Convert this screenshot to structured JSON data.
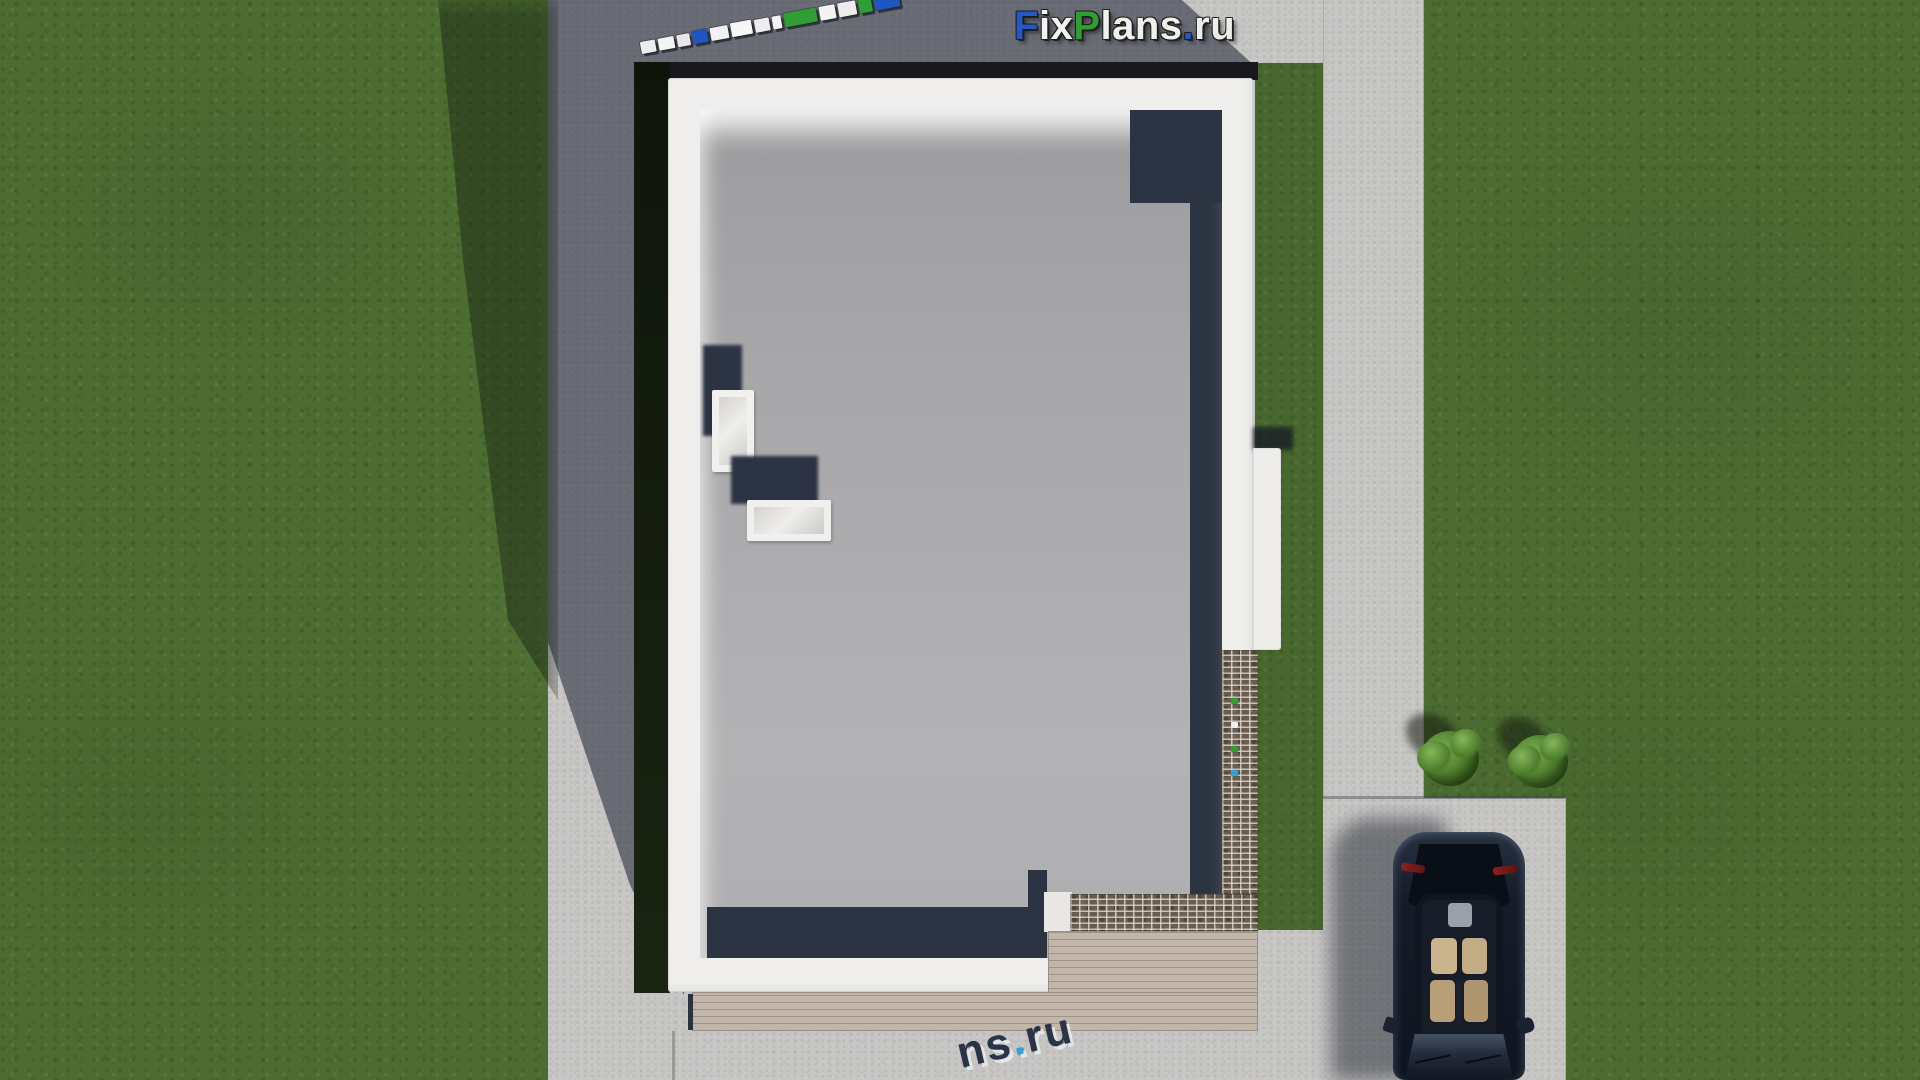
{
  "scene": {
    "description": "Top-down 3D architectural render of a flat-roof house site plan with courtyard, walkway, parking pad, car and shrubs",
    "logo": {
      "full_text": "FixPlans.ru",
      "segments": [
        {
          "text": "F",
          "color": "#2457c8"
        },
        {
          "text": "ix",
          "color": "#f2f2ef"
        },
        {
          "text": "P",
          "color": "#2f9e33"
        },
        {
          "text": "lans",
          "color": "#f0f0ed"
        },
        {
          "text": ".",
          "color": "#2457c8"
        },
        {
          "text": "ru",
          "color": "#edede9"
        }
      ]
    },
    "watermark_bottom": {
      "full_text": "ns.ru",
      "segments": [
        {
          "text": "ns",
          "color": "#2b3347"
        },
        {
          "text": ".",
          "color": "#2aa3de"
        },
        {
          "text": "ru",
          "color": "#2b3347"
        }
      ]
    },
    "watermark_tape": {
      "blocks": [
        {
          "w": 15,
          "h": 12,
          "color": "#ededed"
        },
        {
          "w": 16,
          "h": 12,
          "color": "#f4f4f4"
        },
        {
          "w": 13,
          "h": 12,
          "color": "#e7e7e7"
        },
        {
          "w": 15,
          "h": 13,
          "color": "#1f55c4"
        },
        {
          "w": 18,
          "h": 13,
          "color": "#f2f2f2"
        },
        {
          "w": 21,
          "h": 14,
          "color": "#f7f7f7"
        },
        {
          "w": 15,
          "h": 13,
          "color": "#ededed"
        },
        {
          "w": 9,
          "h": 13,
          "color": "#f2f2f2"
        },
        {
          "w": 33,
          "h": 14,
          "color": "#2f9e33"
        },
        {
          "w": 16,
          "h": 14,
          "color": "#f3f3f3"
        },
        {
          "w": 18,
          "h": 14,
          "color": "#ededed"
        },
        {
          "w": 13,
          "h": 15,
          "color": "#2f9e33"
        },
        {
          "w": 25,
          "h": 16,
          "color": "#1f55c4"
        }
      ]
    },
    "brick_specks": [
      {
        "color": "#2f9e33"
      },
      {
        "color": "#f0f0f0"
      },
      {
        "color": "#2f9e33"
      },
      {
        "color": "#2aa3de"
      }
    ],
    "palette": {
      "grass": "#4c6c31",
      "grass_shadowed": "#24341a",
      "pavement": "#c7c6c4",
      "pavement_shadow": "#5b6170",
      "roof_gray": "#a7a7a9",
      "parapet_white": "#efeeec",
      "roof_shadow_navy": "#2c3342",
      "hedge_dark": "#141b10",
      "brick": "#6a5c4f",
      "deck_wood": "#c2b5a9",
      "car_body": "#141b28",
      "car_seat_tan": "#c0a67e",
      "taillight_red": "#8c2020",
      "bush_green": "#538230"
    },
    "objects": [
      "grass-lawn",
      "concrete-courtyard",
      "building-cast-shadow",
      "flat-roof-house",
      "roof-skylight-1",
      "roof-skylight-2",
      "brick-wall-top",
      "wood-deck-terrace",
      "garden-walkway",
      "parking-pad",
      "parked-car",
      "shrub-1",
      "shrub-2"
    ]
  }
}
